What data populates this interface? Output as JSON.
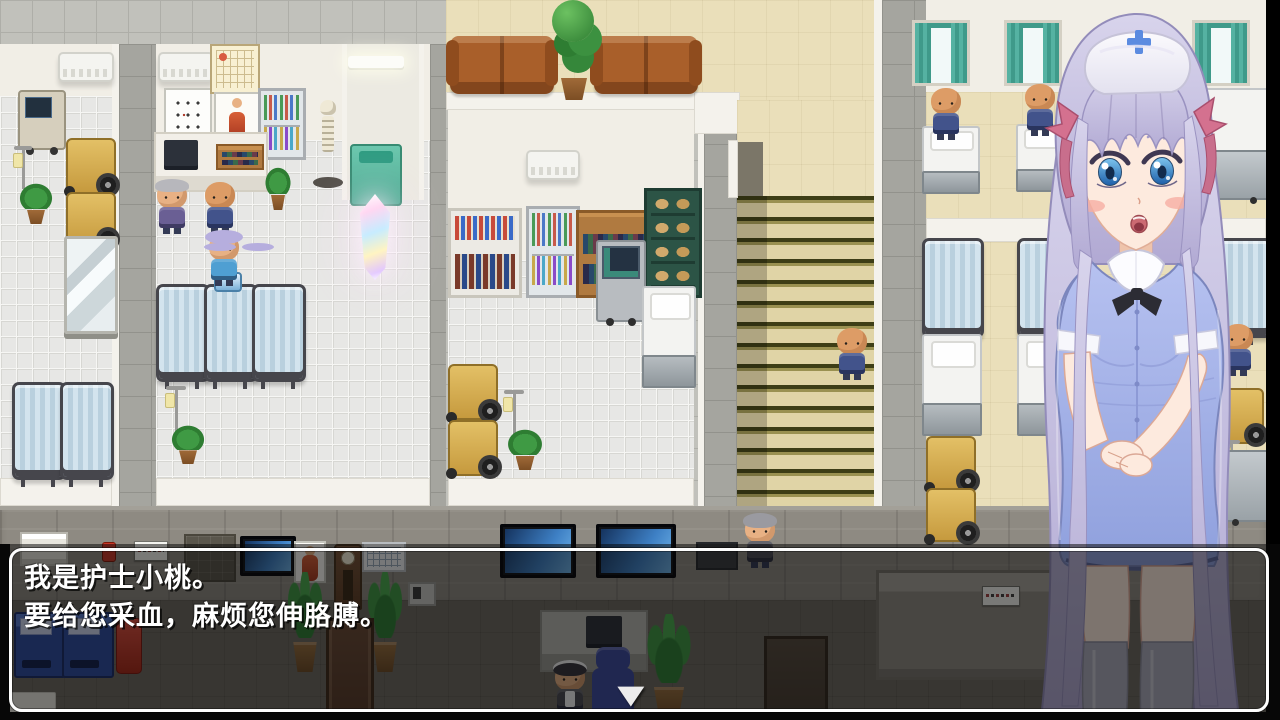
{
  "dialogue": {
    "lines": [
      "我是护士小桃。",
      "要给您采血，麻烦您伸胳膊。"
    ],
    "continue_icon": "▼"
  },
  "palette": {
    "dialog_border": "#fdfdfd",
    "dialog_backdrop": "rgba(8,8,8,0.52)",
    "nurse_uniform_blue": "#a9b5e9",
    "nurse_hair_lavender": "#c1bbdd",
    "nurse_cap_cross_blue": "#5b8be0",
    "hair_ribbon_pink": "#d4718f",
    "curtain_teal": "#4fae9e",
    "privacy_screen_blue": "#cfe2ec",
    "stairs_beige": "#e0d4a6",
    "sofa_brown": "#a95f2a",
    "wheelchair_yellow": "#d9b253",
    "corridor_tile_grey": "#c1c1bb",
    "room_tile_white": "#e7e7e5",
    "lobby_wall_grey": "#8e8a82",
    "lobby_floor_brown": "#6e6961",
    "vending_blue": "#2c4da2"
  }
}
